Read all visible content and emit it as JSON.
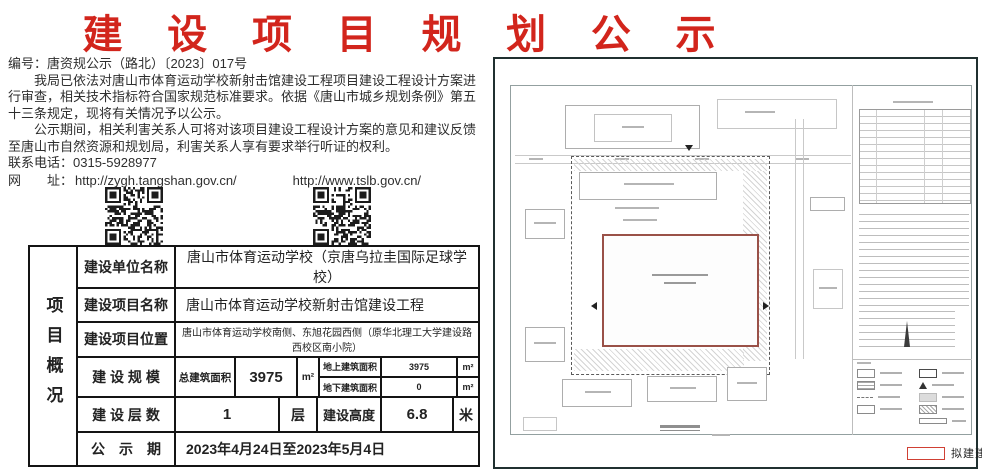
{
  "title": "建 设 项 目 规 划 公 示",
  "notice": {
    "number_line": "编号：唐资规公示（路北）〔2023〕017号",
    "paragraph1": "我局已依法对唐山市体育运动学校新射击馆建设工程项目建设工程设计方案进行审查，相关技术指标符合国家规范标准要求。依据《唐山市城乡规划条例》第五十三条规定，现将有关情况予以公示。",
    "paragraph2": "公示期间，相关利害关系人可将对该项目建设工程设计方案的意见和建议反馈至唐山市自然资源和规划局，利害关系人享有要求举行听证的权利。",
    "phone_line": "联系电话：0315-5928977",
    "web_label": "网　　址：",
    "url_left": "http://zygh.tangshan.gov.cn/",
    "url_right": "http://www.tslb.gov.cn/"
  },
  "table": {
    "side_label": "项目概况",
    "rows": {
      "unit": {
        "label": "建设单位名称",
        "value": "唐山市体育运动学校（京唐乌拉圭国际足球学校）"
      },
      "project": {
        "label": "建设项目名称",
        "value": "唐山市体育运动学校新射击馆建设工程"
      },
      "location": {
        "label": "建设项目位置",
        "value": "唐山市体育运动学校南侧、东旭花园西侧（原华北理工大学建设路西校区南小院）"
      },
      "scale": {
        "label": "建 设 规 模",
        "total_label": "总建筑面积",
        "total_value": "3975",
        "total_unit": "m²",
        "above_label": "地上建筑面积",
        "above_value": "3975",
        "above_unit": "m²",
        "below_label": "地下建筑面积",
        "below_value": "0",
        "below_unit": "m²"
      },
      "floors": {
        "label": "建 设 层 数",
        "value": "1",
        "unit": "层",
        "height_label": "建设高度",
        "height_value": "6.8",
        "height_unit": "米"
      },
      "period": {
        "label": "公　示　期",
        "value": "2023年4月24日至2023年5月4日"
      }
    }
  },
  "plan": {
    "legend_label": "拟建建筑"
  },
  "colors": {
    "title_red": "#d2251c",
    "table_border": "#141414",
    "proposed_outline": "#9a5148",
    "legend_red": "#d04034",
    "panel_border": "#203030"
  }
}
